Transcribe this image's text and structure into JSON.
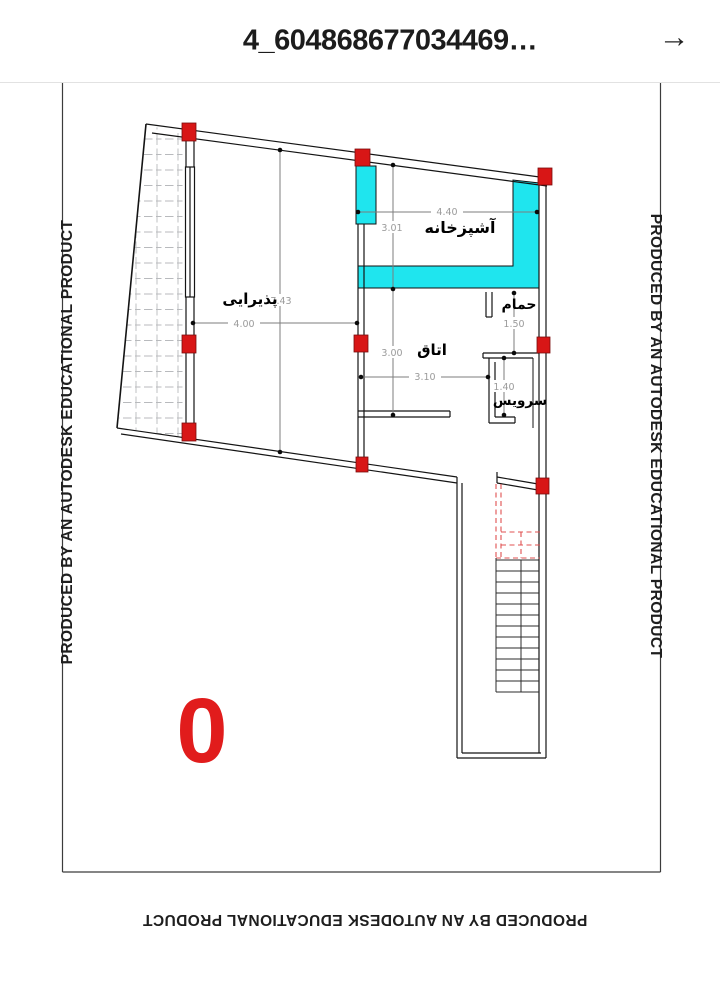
{
  "header": {
    "title": "4_604868677034469…",
    "icons": {
      "forward": "→"
    }
  },
  "watermark": {
    "text": "PRODUCED BY AN AUTODESK EDUCATIONAL PRODUCT"
  },
  "plan": {
    "floor_label": "0",
    "rooms": {
      "kitchen": {
        "label": "آشپزخانه",
        "width_dim": "4.40",
        "height_dim": "3.01"
      },
      "living": {
        "label": "پذیرایی",
        "width_dim": "4.00",
        "height_dim": "7.43"
      },
      "room": {
        "label": "اتاق",
        "width_dim": "3.10",
        "height_dim": "3.00"
      },
      "bathroom": {
        "label": "حمام",
        "height_dim": "1.50"
      },
      "wc": {
        "label": "سرویس",
        "height_dim": "1.40"
      }
    },
    "colors": {
      "highlight_wall": "#1FE5EE",
      "column": "#D81616",
      "floor_label": "#E11C1C",
      "stair_dashed": "#E05050"
    }
  }
}
